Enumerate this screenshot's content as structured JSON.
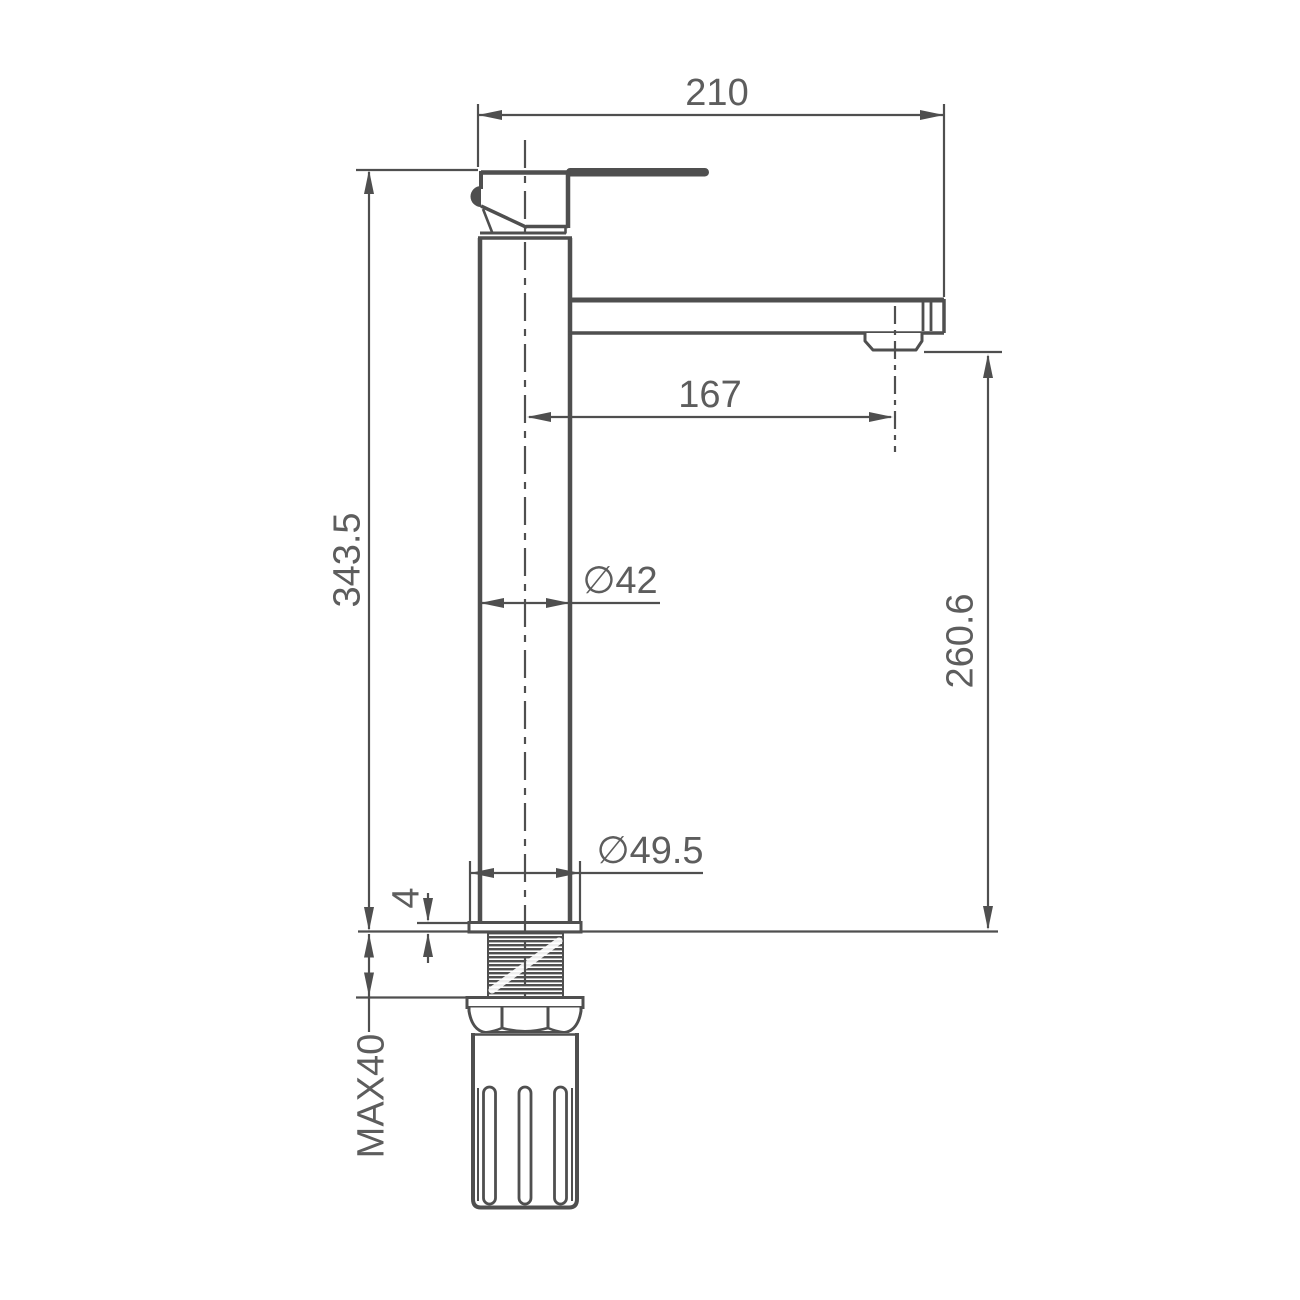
{
  "drawing": {
    "line_color": "#4f4f4f",
    "text_color": "#5d5d5d",
    "background_color": "#ffffff",
    "labels": {
      "top_width": "210",
      "spout_reach": "167",
      "overall_height": "343.5",
      "body_diameter": "∅42",
      "base_diameter": "∅49.5",
      "spout_height": "260.6",
      "base_thickness": "4",
      "max_deck_thickness": "MAX40"
    }
  }
}
